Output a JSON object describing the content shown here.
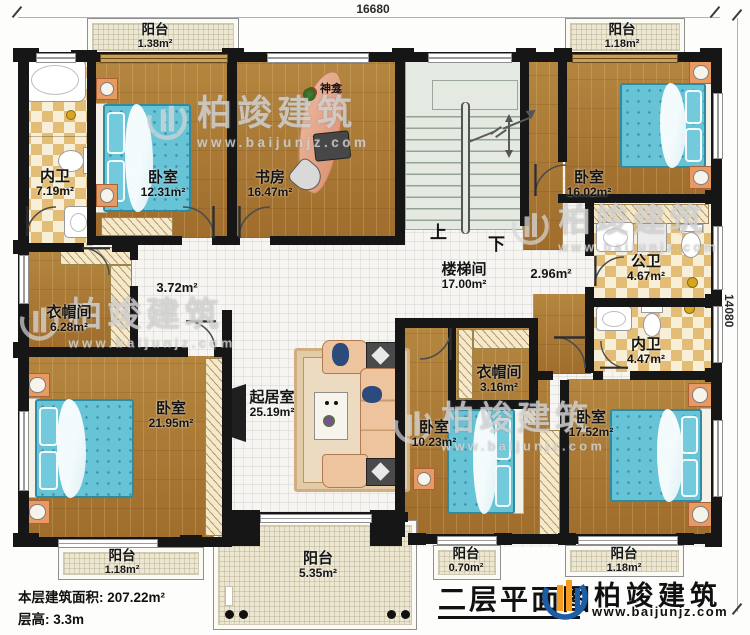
{
  "dims": {
    "top": "16680",
    "right": "14080"
  },
  "rooms": {
    "neiwei1": {
      "name": "内卫",
      "area": "7.19m²"
    },
    "bedroom1": {
      "name": "卧室",
      "area": "12.31m²"
    },
    "study": {
      "name": "书房",
      "area": "16.47m²"
    },
    "shrine": {
      "name": "神龛"
    },
    "bedroom2": {
      "name": "卧室",
      "area": "16.02m²"
    },
    "gongwei": {
      "name": "公卫",
      "area": "4.67m²"
    },
    "stairs": {
      "name": "楼梯间",
      "area": "17.00m²",
      "up": "上",
      "down": "下"
    },
    "hall_left": {
      "area": "3.72m²"
    },
    "hall_right": {
      "area": "2.96m²"
    },
    "cloak1": {
      "name": "衣帽间",
      "area": "6.28m²"
    },
    "bedroom3": {
      "name": "卧室",
      "area": "21.95m²"
    },
    "living": {
      "name": "起居室",
      "area": "25.19m²"
    },
    "cloak2": {
      "name": "衣帽间",
      "area": "3.16m²"
    },
    "neiwei2": {
      "name": "内卫",
      "area": "4.47m²"
    },
    "bedroom4": {
      "name": "卧室",
      "area": "10.23m²"
    },
    "bedroom5": {
      "name": "卧室",
      "area": "17.52m²"
    },
    "balcony_tl": {
      "name": "阳台",
      "area": "1.38m²"
    },
    "balcony_tr": {
      "name": "阳台",
      "area": "1.18m²"
    },
    "balcony_bl": {
      "name": "阳台",
      "area": "1.18m²"
    },
    "balcony_bc": {
      "name": "阳台",
      "area": "5.35m²"
    },
    "balcony_br1": {
      "name": "阳台",
      "area": "0.70m²"
    },
    "balcony_br2": {
      "name": "阳台",
      "area": "1.18m²"
    }
  },
  "footer": {
    "area_label": "本层建筑面积:",
    "area_value": "207.22m²",
    "height_label": "层高:",
    "height_value": "3.3m",
    "title": "二层平面图"
  },
  "brand": {
    "name": "柏竣建筑",
    "url": "www.baijunjz.com"
  },
  "watermark": {
    "name": "柏竣建筑",
    "url": "www.baijunjz.com"
  },
  "colors": {
    "wall": "#161616",
    "wood": "#aa7933",
    "bed": "#67c3d6",
    "logo_blue": "#1d5da6",
    "logo_orange": "#f59b1e"
  }
}
